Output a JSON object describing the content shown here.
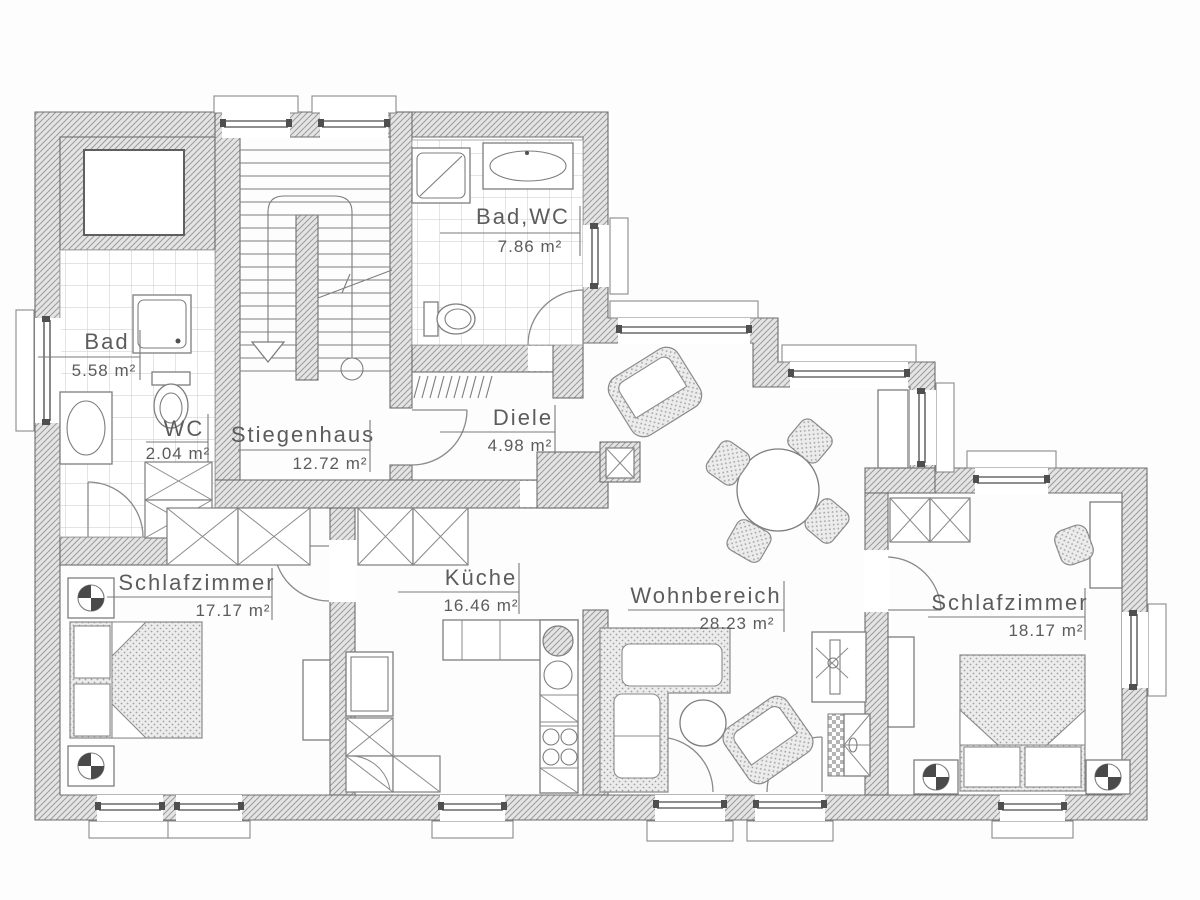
{
  "plan": {
    "rooms": [
      {
        "key": "bad_wc",
        "name": "Bad,WC",
        "area": "7.86 m²"
      },
      {
        "key": "bad",
        "name": "Bad",
        "area": "5.58 m²"
      },
      {
        "key": "wc",
        "name": "WC",
        "area": "2.04 m²"
      },
      {
        "key": "stiegenhaus",
        "name": "Stiegenhaus",
        "area": "12.72 m²"
      },
      {
        "key": "diele",
        "name": "Diele",
        "area": "4.98 m²"
      },
      {
        "key": "schlafzimmer_left",
        "name": "Schlafzimmer",
        "area": "17.17 m²"
      },
      {
        "key": "kueche",
        "name": "Küche",
        "area": "16.46 m²"
      },
      {
        "key": "wohnbereich",
        "name": "Wohnbereich",
        "area": "28.23 m²"
      },
      {
        "key": "schlafzimmer_right",
        "name": "Schlafzimmer",
        "area": "18.17 m²"
      }
    ],
    "colors": {
      "facade_outline": "#F2CF63",
      "wall_fill": "#E3E3E3",
      "wall_hatch": "#9B9B9B",
      "line": "#6E6E6E",
      "text": "#5C5C5C"
    }
  }
}
